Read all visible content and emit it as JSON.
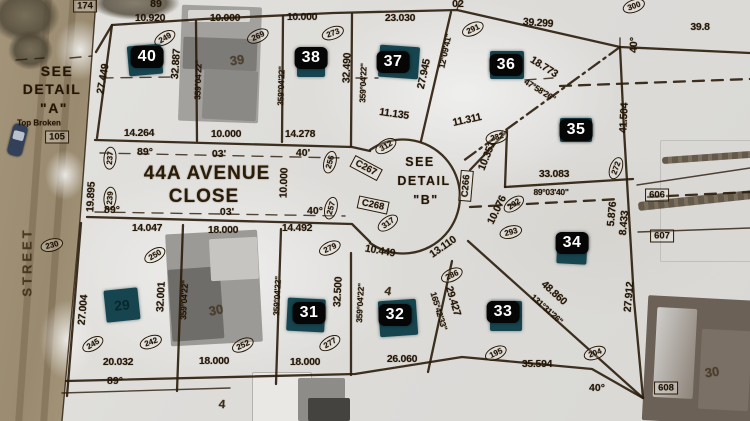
{
  "map": {
    "description": "Aerial winter photo with subdivision plat overlay",
    "colors": {
      "linework": "#2a1c0a",
      "badge_bg": "#060606",
      "badge_text": "#ffffff",
      "marker_patch": "#16454f",
      "street_pavement": "#9c8d72",
      "snow": "#e3e2df"
    },
    "street_names": [
      "44A AVENUE CLOSE",
      "STREET"
    ],
    "detail_notes": [
      "SEE DETAIL \"A\"",
      "SEE DETAIL \"B\"",
      "Top Broken"
    ],
    "lot_badges": [
      {
        "n": "40",
        "x": 147,
        "y": 57
      },
      {
        "n": "38",
        "x": 311,
        "y": 58
      },
      {
        "n": "37",
        "x": 393,
        "y": 62
      },
      {
        "n": "36",
        "x": 506,
        "y": 65
      },
      {
        "n": "35",
        "x": 576,
        "y": 130
      },
      {
        "n": "34",
        "x": 572,
        "y": 243
      },
      {
        "n": "33",
        "x": 503,
        "y": 312
      },
      {
        "n": "32",
        "x": 395,
        "y": 315
      },
      {
        "n": "31",
        "x": 309,
        "y": 313
      }
    ],
    "marker_patches": [
      {
        "x": 145,
        "y": 60,
        "w": 34,
        "h": 30,
        "r": -5
      },
      {
        "x": 311,
        "y": 64,
        "w": 28,
        "h": 26,
        "r": 0
      },
      {
        "x": 399,
        "y": 62,
        "w": 40,
        "h": 32,
        "r": 4
      },
      {
        "x": 507,
        "y": 65,
        "w": 34,
        "h": 28,
        "r": 0
      },
      {
        "x": 576,
        "y": 130,
        "w": 32,
        "h": 24,
        "r": 0
      },
      {
        "x": 572,
        "y": 250,
        "w": 30,
        "h": 28,
        "r": 3
      },
      {
        "x": 506,
        "y": 316,
        "w": 32,
        "h": 30,
        "r": 0
      },
      {
        "x": 398,
        "y": 318,
        "w": 38,
        "h": 36,
        "r": -4
      },
      {
        "x": 306,
        "y": 315,
        "w": 38,
        "h": 33,
        "r": 3
      },
      {
        "x": 122,
        "y": 305,
        "w": 34,
        "h": 32,
        "r": -6,
        "label": "29"
      }
    ],
    "labels": [
      {
        "t": "174",
        "c": "box",
        "x": 85,
        "y": 6
      },
      {
        "t": "89",
        "c": "deg",
        "x": 156,
        "y": 4
      },
      {
        "t": "10.920",
        "x": 150,
        "y": 18
      },
      {
        "t": "10.000",
        "x": 225,
        "y": 18
      },
      {
        "t": "10.000",
        "x": 302,
        "y": 17
      },
      {
        "t": "23.030",
        "x": 400,
        "y": 18
      },
      {
        "t": "02",
        "c": "deg",
        "x": 458,
        "y": 4
      },
      {
        "t": "39.299",
        "x": 538,
        "y": 23,
        "r": 4
      },
      {
        "t": "39.8",
        "x": 700,
        "y": 27
      },
      {
        "t": "300",
        "c": "circ",
        "x": 634,
        "y": 6,
        "r": -20
      },
      {
        "t": "249",
        "c": "circ",
        "x": 165,
        "y": 38,
        "r": -30
      },
      {
        "t": "269",
        "c": "circ",
        "x": 258,
        "y": 36,
        "r": -25
      },
      {
        "t": "273",
        "c": "circ",
        "x": 333,
        "y": 33,
        "r": -20
      },
      {
        "t": "291",
        "c": "circ",
        "x": 473,
        "y": 29,
        "r": -25
      },
      {
        "t": "27.449",
        "x": 103,
        "y": 79,
        "r": -80
      },
      {
        "t": "32.887",
        "x": 176,
        "y": 64,
        "r": -86
      },
      {
        "t": "359°04'22\"",
        "c": "b",
        "x": 198,
        "y": 80,
        "r": -88
      },
      {
        "t": "39",
        "c": "roof",
        "x": 237,
        "y": 60,
        "r": -8
      },
      {
        "t": "359°04'22\"",
        "c": "b",
        "x": 281,
        "y": 86,
        "r": -88
      },
      {
        "t": "32.490",
        "x": 347,
        "y": 68,
        "r": -88
      },
      {
        "t": "359°04'22\"",
        "c": "b",
        "x": 363,
        "y": 83,
        "r": -88
      },
      {
        "t": "27.945",
        "x": 424,
        "y": 74,
        "r": -78
      },
      {
        "t": "12°09'41\"",
        "c": "b",
        "x": 445,
        "y": 51,
        "r": -78
      },
      {
        "t": "18.773",
        "x": 544,
        "y": 67,
        "r": 32
      },
      {
        "t": "47°58'26\"",
        "c": "b",
        "x": 540,
        "y": 90,
        "r": 32
      },
      {
        "t": "40°",
        "c": "deg",
        "x": 634,
        "y": 45,
        "r": -88
      },
      {
        "t": "41.504",
        "x": 624,
        "y": 118,
        "r": -87
      },
      {
        "t": "SEE",
        "c": "note2",
        "x": 57,
        "y": 71
      },
      {
        "t": "DETAIL",
        "c": "note2",
        "x": 52,
        "y": 89
      },
      {
        "t": "\"A\"",
        "c": "note2",
        "x": 54,
        "y": 108
      },
      {
        "t": "Top Broken",
        "c": "small",
        "x": 39,
        "y": 123
      },
      {
        "t": "105",
        "c": "box",
        "x": 57,
        "y": 137
      },
      {
        "t": "STREET",
        "c": "vstreet",
        "x": 27,
        "y": 262,
        "r": -90
      },
      {
        "t": "230",
        "c": "circ",
        "x": 52,
        "y": 245,
        "r": -15
      },
      {
        "t": "19.895",
        "x": 91,
        "y": 197,
        "r": -87
      },
      {
        "t": "237",
        "c": "circ",
        "x": 110,
        "y": 158,
        "r": -85
      },
      {
        "t": "239",
        "c": "circ",
        "x": 110,
        "y": 198,
        "r": -85
      },
      {
        "t": "14.264",
        "x": 139,
        "y": 133
      },
      {
        "t": "10.000",
        "x": 226,
        "y": 134
      },
      {
        "t": "14.278",
        "x": 300,
        "y": 134
      },
      {
        "t": "89°",
        "c": "deg",
        "x": 145,
        "y": 152
      },
      {
        "t": "03'",
        "c": "deg",
        "x": 219,
        "y": 154
      },
      {
        "t": "40'",
        "c": "deg",
        "x": 303,
        "y": 153
      },
      {
        "t": "44A AVENUE",
        "c": "street",
        "x": 207,
        "y": 174
      },
      {
        "t": "CLOSE",
        "c": "street",
        "x": 204,
        "y": 197
      },
      {
        "t": "89°",
        "c": "deg",
        "x": 112,
        "y": 210
      },
      {
        "t": "03'",
        "c": "deg",
        "x": 227,
        "y": 212
      },
      {
        "t": "40°",
        "c": "deg",
        "x": 315,
        "y": 211
      },
      {
        "t": "10.000",
        "x": 284,
        "y": 183,
        "r": -88
      },
      {
        "t": "256",
        "c": "circ",
        "x": 330,
        "y": 162,
        "r": -75
      },
      {
        "t": "257",
        "c": "circ",
        "x": 331,
        "y": 208,
        "r": -75
      },
      {
        "t": "11.135",
        "x": 394,
        "y": 114,
        "r": 8
      },
      {
        "t": "11.311",
        "x": 467,
        "y": 120,
        "r": -12
      },
      {
        "t": "232",
        "c": "circ",
        "x": 497,
        "y": 137,
        "r": -15
      },
      {
        "t": "10.351",
        "x": 487,
        "y": 156,
        "r": -68
      },
      {
        "t": "SEE",
        "c": "note",
        "x": 420,
        "y": 162
      },
      {
        "t": "DETAIL",
        "c": "note",
        "x": 424,
        "y": 181
      },
      {
        "t": "\"B\"",
        "c": "note",
        "x": 426,
        "y": 200
      },
      {
        "t": "312",
        "c": "circ",
        "x": 386,
        "y": 146,
        "r": -30
      },
      {
        "t": "C267",
        "c": "box",
        "x": 366,
        "y": 168,
        "r": 28
      },
      {
        "t": "C268",
        "c": "box",
        "x": 373,
        "y": 205,
        "r": 12
      },
      {
        "t": "317",
        "c": "circ",
        "x": 388,
        "y": 223,
        "r": -35
      },
      {
        "t": "C266",
        "c": "box",
        "x": 466,
        "y": 186,
        "r": -85
      },
      {
        "t": "292",
        "c": "circ",
        "x": 514,
        "y": 204,
        "r": -35
      },
      {
        "t": "293",
        "c": "circ",
        "x": 511,
        "y": 232,
        "r": -15
      },
      {
        "t": "10.076",
        "x": 497,
        "y": 210,
        "r": -64
      },
      {
        "t": "33.083",
        "x": 554,
        "y": 174
      },
      {
        "t": "89°03'40\"",
        "c": "b",
        "x": 551,
        "y": 192
      },
      {
        "t": "272",
        "c": "circ",
        "x": 616,
        "y": 168,
        "r": -70
      },
      {
        "t": "5.876",
        "x": 612,
        "y": 214,
        "r": -85
      },
      {
        "t": "8.433",
        "x": 624,
        "y": 223,
        "r": -85
      },
      {
        "t": "606",
        "c": "box",
        "x": 657,
        "y": 195
      },
      {
        "t": "607",
        "c": "box",
        "x": 662,
        "y": 236
      },
      {
        "t": "14.047",
        "x": 147,
        "y": 228
      },
      {
        "t": "18.000",
        "x": 223,
        "y": 230
      },
      {
        "t": "14.492",
        "x": 297,
        "y": 228
      },
      {
        "t": "250",
        "c": "circ",
        "x": 155,
        "y": 255,
        "r": -30
      },
      {
        "t": "27.004",
        "x": 83,
        "y": 310,
        "r": -85
      },
      {
        "t": "32.001",
        "x": 161,
        "y": 297,
        "r": -87
      },
      {
        "t": "359°04'22\"",
        "c": "b",
        "x": 184,
        "y": 300,
        "r": -87
      },
      {
        "t": "30",
        "c": "roof",
        "x": 216,
        "y": 310,
        "r": -10
      },
      {
        "t": "10.449",
        "x": 380,
        "y": 251,
        "r": 10
      },
      {
        "t": "13.110",
        "x": 443,
        "y": 247,
        "r": -35
      },
      {
        "t": "279",
        "c": "circ",
        "x": 330,
        "y": 248,
        "r": -25
      },
      {
        "t": "286",
        "c": "circ",
        "x": 452,
        "y": 275,
        "r": -25
      },
      {
        "t": "359°04'22\"",
        "c": "b",
        "x": 277,
        "y": 296,
        "r": -87
      },
      {
        "t": "32.500",
        "x": 338,
        "y": 292,
        "r": -87
      },
      {
        "t": "359°04'22\"",
        "c": "b",
        "x": 360,
        "y": 303,
        "r": -87
      },
      {
        "t": "29.427",
        "x": 453,
        "y": 301,
        "r": 73
      },
      {
        "t": "165°42'33\"",
        "c": "b",
        "x": 439,
        "y": 311,
        "r": 73
      },
      {
        "t": "48.860",
        "x": 554,
        "y": 293,
        "r": 42
      },
      {
        "t": "131°31'26\"",
        "c": "b",
        "x": 547,
        "y": 309,
        "r": 42
      },
      {
        "t": "27.912",
        "x": 629,
        "y": 297,
        "r": -85
      },
      {
        "t": "277",
        "c": "circ",
        "x": 330,
        "y": 343,
        "r": -30
      },
      {
        "t": "195",
        "c": "circ",
        "x": 496,
        "y": 353,
        "r": -25
      },
      {
        "t": "204",
        "c": "circ",
        "x": 595,
        "y": 353,
        "r": -20
      },
      {
        "t": "20.032",
        "x": 118,
        "y": 362
      },
      {
        "t": "18.000",
        "x": 214,
        "y": 361
      },
      {
        "t": "18.000",
        "x": 305,
        "y": 362
      },
      {
        "t": "26.060",
        "x": 402,
        "y": 359
      },
      {
        "t": "35.594",
        "x": 537,
        "y": 364
      },
      {
        "t": "89°",
        "c": "deg",
        "x": 115,
        "y": 381
      },
      {
        "t": "40°",
        "c": "deg",
        "x": 597,
        "y": 388
      },
      {
        "t": "608",
        "c": "box",
        "x": 666,
        "y": 388
      },
      {
        "t": "30",
        "c": "roof",
        "x": 712,
        "y": 372,
        "r": -8
      },
      {
        "t": "245",
        "c": "circ",
        "x": 93,
        "y": 344,
        "r": -30
      },
      {
        "t": "242",
        "c": "circ",
        "x": 151,
        "y": 342,
        "r": -20
      },
      {
        "t": "252",
        "c": "circ",
        "x": 243,
        "y": 345,
        "r": -25
      },
      {
        "t": "4",
        "c": "scribble",
        "x": 388,
        "y": 291,
        "r": 10
      },
      {
        "t": "4",
        "c": "scribble",
        "x": 222,
        "y": 404,
        "r": 5
      }
    ]
  }
}
